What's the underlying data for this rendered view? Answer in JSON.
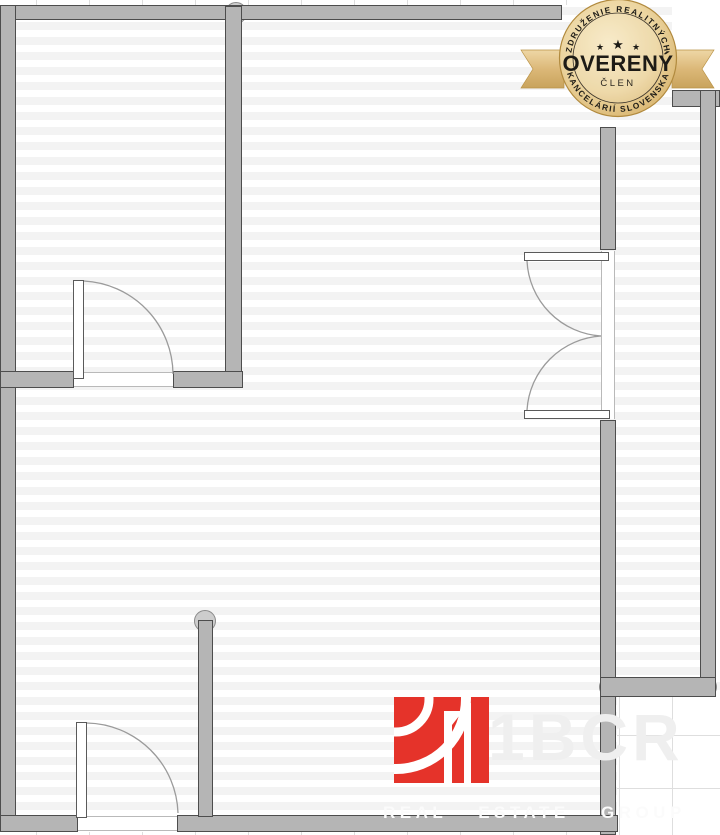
{
  "badge": {
    "arc_top": "ZDRUŽENIE REALITNÝCH",
    "stars": [
      "★",
      "★",
      "★"
    ],
    "title": "OVERENÝ",
    "subtitle": "ČLEN",
    "arc_bottom": "KANCELÁRIÍ SLOVENSKA"
  },
  "watermark": {
    "brand": "1BCR",
    "tagline": "REAL ESTATE GROUP"
  },
  "colors": {
    "wall_fill": "#b5b5b5",
    "wall_outline": "#4d4d4d",
    "stripe": "#f3f3f3",
    "grid": "#dedede",
    "door_arc": "#9b9b9b",
    "badge_gold_light": "#f7e9c4",
    "badge_gold_mid": "#e3c37e",
    "badge_gold_dark": "#c49a4e",
    "ribbon_gold": "#dcb878",
    "badge_text": "#1d1b16",
    "logo_red": "#e5332a"
  },
  "floorplan": {
    "walls": [
      {
        "name": "top-wall",
        "r": [
          0,
          5,
          562,
          15
        ]
      },
      {
        "name": "left-wall",
        "r": [
          0,
          5,
          16,
          827
        ]
      },
      {
        "name": "room-divider-wall",
        "r": [
          225,
          6,
          17,
          382
        ]
      },
      {
        "name": "mid-wall-left",
        "r": [
          0,
          371,
          74,
          17
        ]
      },
      {
        "name": "mid-wall-right",
        "r": [
          173,
          371,
          70,
          17
        ]
      },
      {
        "name": "right-wall-upper",
        "r": [
          600,
          127,
          16,
          123
        ]
      },
      {
        "name": "right-wall-lower",
        "r": [
          600,
          420,
          16,
          415
        ]
      },
      {
        "name": "bottom-wall-left",
        "r": [
          0,
          815,
          78,
          17
        ]
      },
      {
        "name": "bottom-wall-main",
        "r": [
          177,
          815,
          441,
          17
        ]
      },
      {
        "name": "entry-stub-wall",
        "r": [
          198,
          620,
          15,
          197
        ]
      },
      {
        "name": "balcony-top-stub",
        "r": [
          672,
          90,
          48,
          17
        ]
      },
      {
        "name": "balcony-right-wall",
        "r": [
          700,
          90,
          16,
          607
        ]
      },
      {
        "name": "balcony-bottom-wall",
        "r": [
          600,
          677,
          116,
          20
        ]
      }
    ],
    "joints": [
      {
        "name": "wall-joint",
        "c": [
          236,
          13,
          11
        ]
      },
      {
        "name": "wall-joint",
        "c": [
          6,
          380,
          11
        ]
      },
      {
        "name": "wall-joint",
        "c": [
          205,
          621,
          11
        ]
      },
      {
        "name": "wall-joint",
        "c": [
          609,
          687,
          10
        ]
      },
      {
        "name": "wall-joint",
        "c": [
          707,
          687,
          10
        ]
      }
    ],
    "thresholds": [
      {
        "name": "door-opening-top-room",
        "r": [
          73,
          372,
          101,
          15
        ],
        "o": "h"
      },
      {
        "name": "door-opening-entry",
        "r": [
          77,
          816,
          101,
          15
        ],
        "o": "h"
      },
      {
        "name": "door-opening-balcony",
        "r": [
          601,
          251,
          14,
          168
        ],
        "o": "v"
      }
    ],
    "door_leaves": [
      {
        "name": "door-leaf-top-room",
        "r": [
          73,
          280,
          11,
          99
        ]
      },
      {
        "name": "door-leaf-entry",
        "r": [
          76,
          722,
          11,
          96
        ]
      },
      {
        "name": "door-leaf-balcony-upper",
        "r": [
          524,
          252,
          85,
          9
        ]
      },
      {
        "name": "door-leaf-balcony-lower",
        "r": [
          524,
          410,
          86,
          9
        ]
      }
    ],
    "door_arcs": [
      {
        "name": "door-swing-arc",
        "d": "M 84 281 A 94 94 0 0 1 173 374"
      },
      {
        "name": "door-swing-arc",
        "d": "M 87 723 A 93 93 0 0 1 178 813"
      },
      {
        "name": "door-swing-arc",
        "d": "M 527 261 A 79 79 0 0 0 601 336"
      },
      {
        "name": "door-swing-arc",
        "d": "M 527 410 A 79 79 0 0 1 601 336"
      }
    ],
    "outside_patches": [
      {
        "name": "outside-top-strip",
        "r": [
          0,
          0,
          720,
          5
        ],
        "g": "v",
        "p": [
          36,
          0
        ]
      },
      {
        "name": "outside-bottom-strip",
        "r": [
          0,
          832,
          618,
          3
        ],
        "g": "v",
        "p": [
          36,
          0
        ]
      },
      {
        "name": "outside-right-sliver",
        "r": [
          716,
          107,
          4,
          570
        ],
        "g": "",
        "p": [
          0,
          0
        ]
      },
      {
        "name": "outside-top-right",
        "r": [
          672,
          0,
          48,
          90
        ],
        "g": "",
        "p": [
          0,
          0
        ]
      },
      {
        "name": "outside-bottom-right",
        "r": [
          617,
          697,
          103,
          138
        ],
        "g": "vh",
        "p": [
          2,
          -15
        ]
      }
    ]
  }
}
